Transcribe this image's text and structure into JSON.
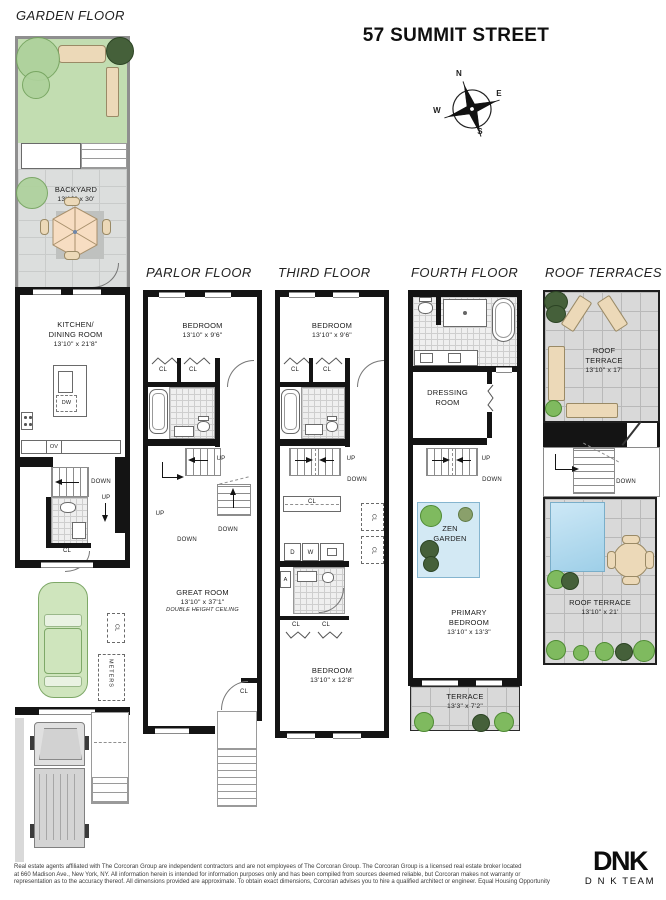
{
  "title": "57 SUMMIT STREET",
  "compass": {
    "north": "N",
    "east": "E",
    "south": "S",
    "west": "W"
  },
  "labels": {
    "cl": "CL",
    "up": "UP",
    "down": "DOWN",
    "dw": "DW",
    "ov": "OV",
    "d": "D",
    "w": "W",
    "a": "A",
    "meters": "METERS"
  },
  "floors": {
    "garden": {
      "title": "GARDEN FLOOR",
      "rooms": {
        "backyard": {
          "name": "BACKYARD",
          "dims": "13'10\" x 30'"
        },
        "kitchen_dining": {
          "name": "KITCHEN/",
          "name2": "DINING ROOM",
          "dims": "13'10\" x 21'8\""
        }
      }
    },
    "parlor": {
      "title": "PARLOR FLOOR",
      "rooms": {
        "bedroom": {
          "name": "BEDROOM",
          "dims": "13'10\" x 9'6\""
        },
        "great_room": {
          "name": "GREAT ROOM",
          "dims": "13'10\" x 37'1\"",
          "note": "DOUBLE HEIGHT CEILING"
        }
      }
    },
    "third": {
      "title": "THIRD FLOOR",
      "rooms": {
        "bedroom_front": {
          "name": "BEDROOM",
          "dims": "13'10\" x 9'6\""
        },
        "bedroom_rear": {
          "name": "BEDROOM",
          "dims": "13'10\" x 12'8\""
        }
      }
    },
    "fourth": {
      "title": "FOURTH FLOOR",
      "rooms": {
        "dressing": {
          "name": "DRESSING",
          "name2": "ROOM"
        },
        "zen_garden": {
          "name": "ZEN",
          "name2": "GARDEN"
        },
        "primary_bedroom": {
          "name": "PRIMARY",
          "name2": "BEDROOM",
          "dims": "13'10\" x 13'3\""
        },
        "terrace": {
          "name": "TERRACE",
          "dims": "13'3\" x 7'2\""
        }
      }
    },
    "roof": {
      "title": "ROOF TERRACES",
      "rooms": {
        "upper_terrace": {
          "name": "ROOF",
          "name2": "TERRACE",
          "dims": "13'10\" x 17'"
        },
        "lower_terrace": {
          "name": "ROOF TERRACE",
          "dims": "13'10\" x 21'"
        }
      }
    }
  },
  "footer": {
    "disclaimer": [
      "Real estate agents affiliated with The Corcoran Group are independent contractors and are not employees of The Corcoran Group. The Corcoran Group is a licensed real estate broker located",
      "at 660 Madison Ave., New York, NY. All information herein is intended for information purposes only and has been compiled from sources deemed reliable, but Corcoran makes not warranty or",
      "representation as to the accuracy thereof. All dimensions provided are approximate. To obtain exact dimensions, Corcoran advises you to hire a qualified architect or engineer. Equal Housing Opportunity"
    ]
  },
  "logo": {
    "brand": "DNK",
    "team": "D N K TEAM"
  },
  "palette": {
    "grass": "#c2ddb1",
    "patio": "#dcdedd",
    "roof_tile": "#d9d9d9",
    "furniture": "#ecd9b8",
    "car": "#cfe5bd",
    "zen_garden": "#d3e9f4",
    "skylight": "#9ecfe8",
    "wall": "#141414"
  }
}
